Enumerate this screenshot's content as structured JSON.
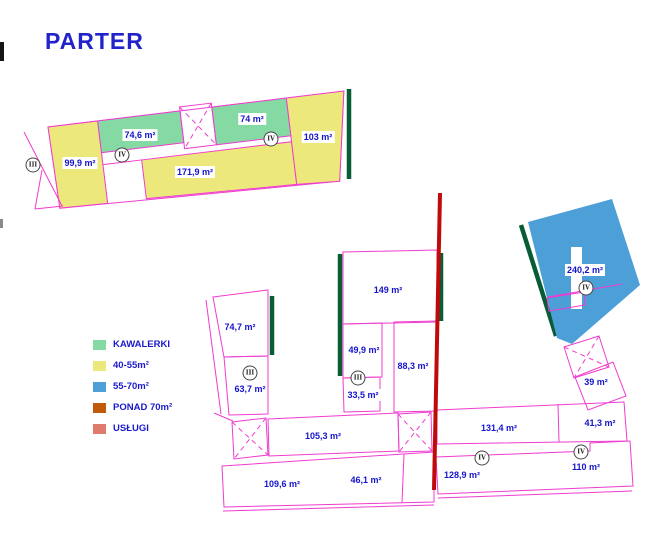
{
  "title": "PARTER",
  "colors": {
    "studio_green": "#85daa4",
    "size_40_55_yellow": "#ede87c",
    "size_55_70_blue": "#4d9fd8",
    "over_70_orange": "#c2590b",
    "services_salmon": "#df7a6e",
    "outline_magenta": "#f03ccf",
    "boundary_dark_green": "#085c36",
    "divider_red": "#c00a0a",
    "label_blue": "#1414cc"
  },
  "legend": {
    "items": [
      {
        "label": "KAWALERKI",
        "color": "#85daa4"
      },
      {
        "label": "40-55m²",
        "color": "#ede87c"
      },
      {
        "label": "55-70m²",
        "color": "#4d9fd8"
      },
      {
        "label": "PONAD 70m²",
        "color": "#c2590b"
      },
      {
        "label": "USŁUGI",
        "color": "#df7a6e"
      }
    ]
  },
  "plan": {
    "area_labels": [
      {
        "text": "99,9 m²",
        "x": 80,
        "y": 163
      },
      {
        "text": "74,6 m²",
        "x": 140,
        "y": 135
      },
      {
        "text": "74 m²",
        "x": 252,
        "y": 119
      },
      {
        "text": "103 m²",
        "x": 318,
        "y": 137
      },
      {
        "text": "171,9 m²",
        "x": 195,
        "y": 172
      },
      {
        "text": "74,7 m²",
        "x": 240,
        "y": 327
      },
      {
        "text": "63,7 m²",
        "x": 250,
        "y": 389
      },
      {
        "text": "149 m²",
        "x": 388,
        "y": 290
      },
      {
        "text": "49,9 m²",
        "x": 364,
        "y": 350
      },
      {
        "text": "33,5 m²",
        "x": 363,
        "y": 395
      },
      {
        "text": "88,3 m²",
        "x": 413,
        "y": 366
      },
      {
        "text": "240,2 m²",
        "x": 585,
        "y": 270
      },
      {
        "text": "39 m²",
        "x": 596,
        "y": 382
      },
      {
        "text": "105,3 m²",
        "x": 323,
        "y": 436
      },
      {
        "text": "131,4 m²",
        "x": 499,
        "y": 428
      },
      {
        "text": "41,3 m²",
        "x": 600,
        "y": 423
      },
      {
        "text": "109,6 m²",
        "x": 282,
        "y": 484
      },
      {
        "text": "46,1 m²",
        "x": 366,
        "y": 480
      },
      {
        "text": "128,9 m²",
        "x": 462,
        "y": 475
      },
      {
        "text": "110 m²",
        "x": 586,
        "y": 467
      }
    ],
    "unit_markers": [
      {
        "numeral": "III",
        "x": 33,
        "y": 165
      },
      {
        "numeral": "IV",
        "x": 122,
        "y": 155
      },
      {
        "numeral": "IV",
        "x": 271,
        "y": 139
      },
      {
        "numeral": "III",
        "x": 250,
        "y": 373
      },
      {
        "numeral": "III",
        "x": 358,
        "y": 378
      },
      {
        "numeral": "IV",
        "x": 586,
        "y": 288
      },
      {
        "numeral": "IV",
        "x": 482,
        "y": 458
      },
      {
        "numeral": "IV",
        "x": 581,
        "y": 452
      }
    ]
  }
}
